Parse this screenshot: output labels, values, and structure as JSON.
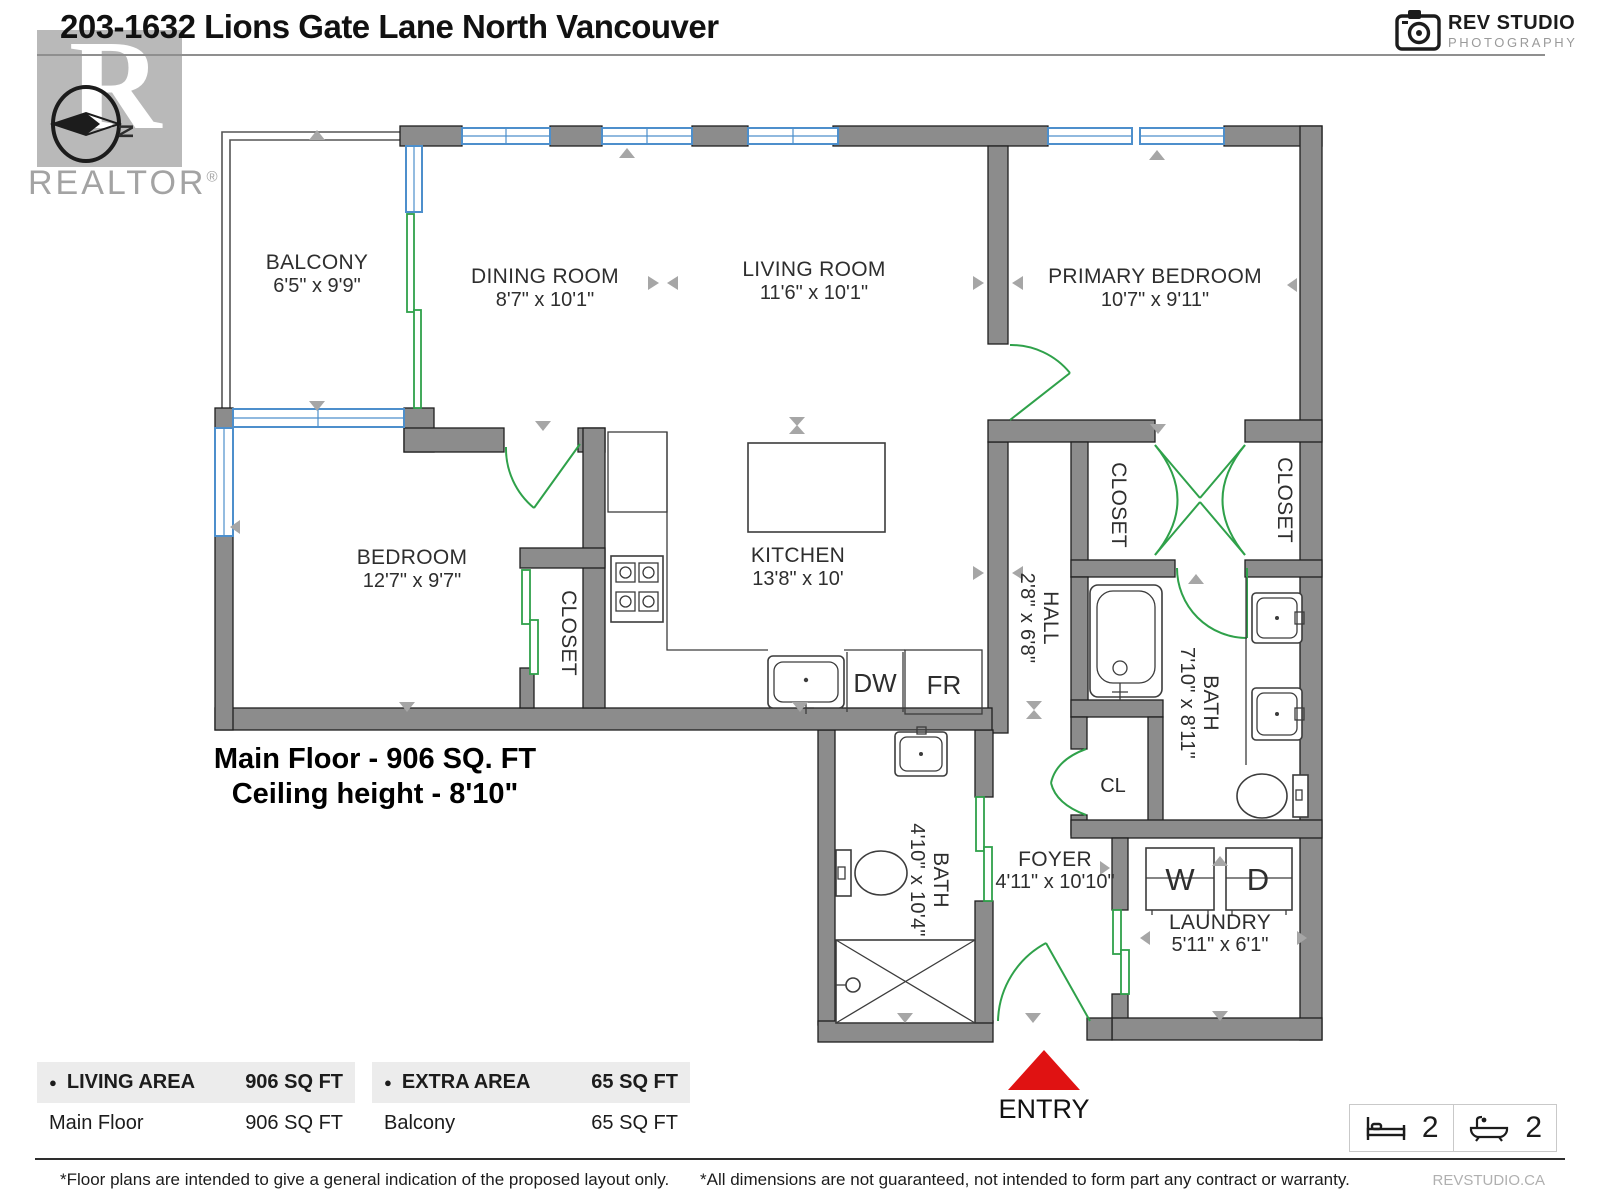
{
  "colors": {
    "wall": "#8c8c8c",
    "wall-stroke": "#1f1f1f",
    "window": "#4d8fcc",
    "door": "#2fa14a",
    "marker": "#a6a6a6",
    "entry": "#e01212",
    "label": "#2e2e2e",
    "logo-gray": "#b9b9b9",
    "table-header-bg": "#ececec"
  },
  "header": {
    "title": "203-1632 Lions Gate Lane North Vancouver",
    "logo_letter": "R",
    "realtor": "REALTOR",
    "reg": "®",
    "compass_n": "N",
    "studio": "REV STUDIO",
    "studio_sub": "PHOTOGRAPHY"
  },
  "plan": {
    "rooms": {
      "balcony": {
        "name": "BALCONY",
        "dims": "6'5\" x 9'9\""
      },
      "dining": {
        "name": "DINING ROOM",
        "dims": "8'7\" x 10'1\""
      },
      "living": {
        "name": "LIVING ROOM",
        "dims": "11'6\" x 10'1\""
      },
      "primary": {
        "name": "PRIMARY BEDROOM",
        "dims": "10'7\" x 9'11\""
      },
      "bedroom": {
        "name": "BEDROOM",
        "dims": "12'7\" x 9'7\""
      },
      "kitchen": {
        "name": "KITCHEN",
        "dims": "13'8\" x 10'"
      },
      "hall": {
        "name": "HALL",
        "dims": "2'8\" x 6'8\""
      },
      "bath_main": {
        "name": "BATH",
        "dims": "7'10\" x 8'11\""
      },
      "bath_2nd": {
        "name": "BATH",
        "dims": "4'10\" x 10'4\""
      },
      "foyer": {
        "name": "FOYER",
        "dims": "4'11\" x 10'10\""
      },
      "laundry": {
        "name": "LAUNDRY",
        "dims": "5'11\" x 6'1\""
      },
      "closet_bedroom": {
        "name": "CLOSET"
      },
      "closet_primary_left": {
        "name": "CLOSET"
      },
      "closet_primary_right": {
        "name": "CLOSET"
      },
      "cl": {
        "name": "CL"
      }
    },
    "appliances": {
      "dishwasher": "DW",
      "fridge": "FR",
      "washer": "W",
      "dryer": "D"
    },
    "note1": "Main Floor - 906 SQ. FT",
    "note2": "Ceiling height - 8'10\"",
    "entry": "ENTRY"
  },
  "tables": [
    {
      "header": "LIVING AREA",
      "header_value": "906 SQ FT",
      "row_label": "Main Floor",
      "row_value": "906 SQ FT"
    },
    {
      "header": "EXTRA AREA",
      "header_value": "65 SQ FT",
      "row_label": "Balcony",
      "row_value": "65 SQ FT"
    }
  ],
  "summary": {
    "bedrooms": "2",
    "bathrooms": "2"
  },
  "footer": {
    "left": "*Floor plans are intended to give a general indication of the proposed layout only.",
    "right": "*All dimensions are not guaranteed, not intended to form part any contract or warranty.",
    "site": "REVSTUDIO.CA"
  }
}
